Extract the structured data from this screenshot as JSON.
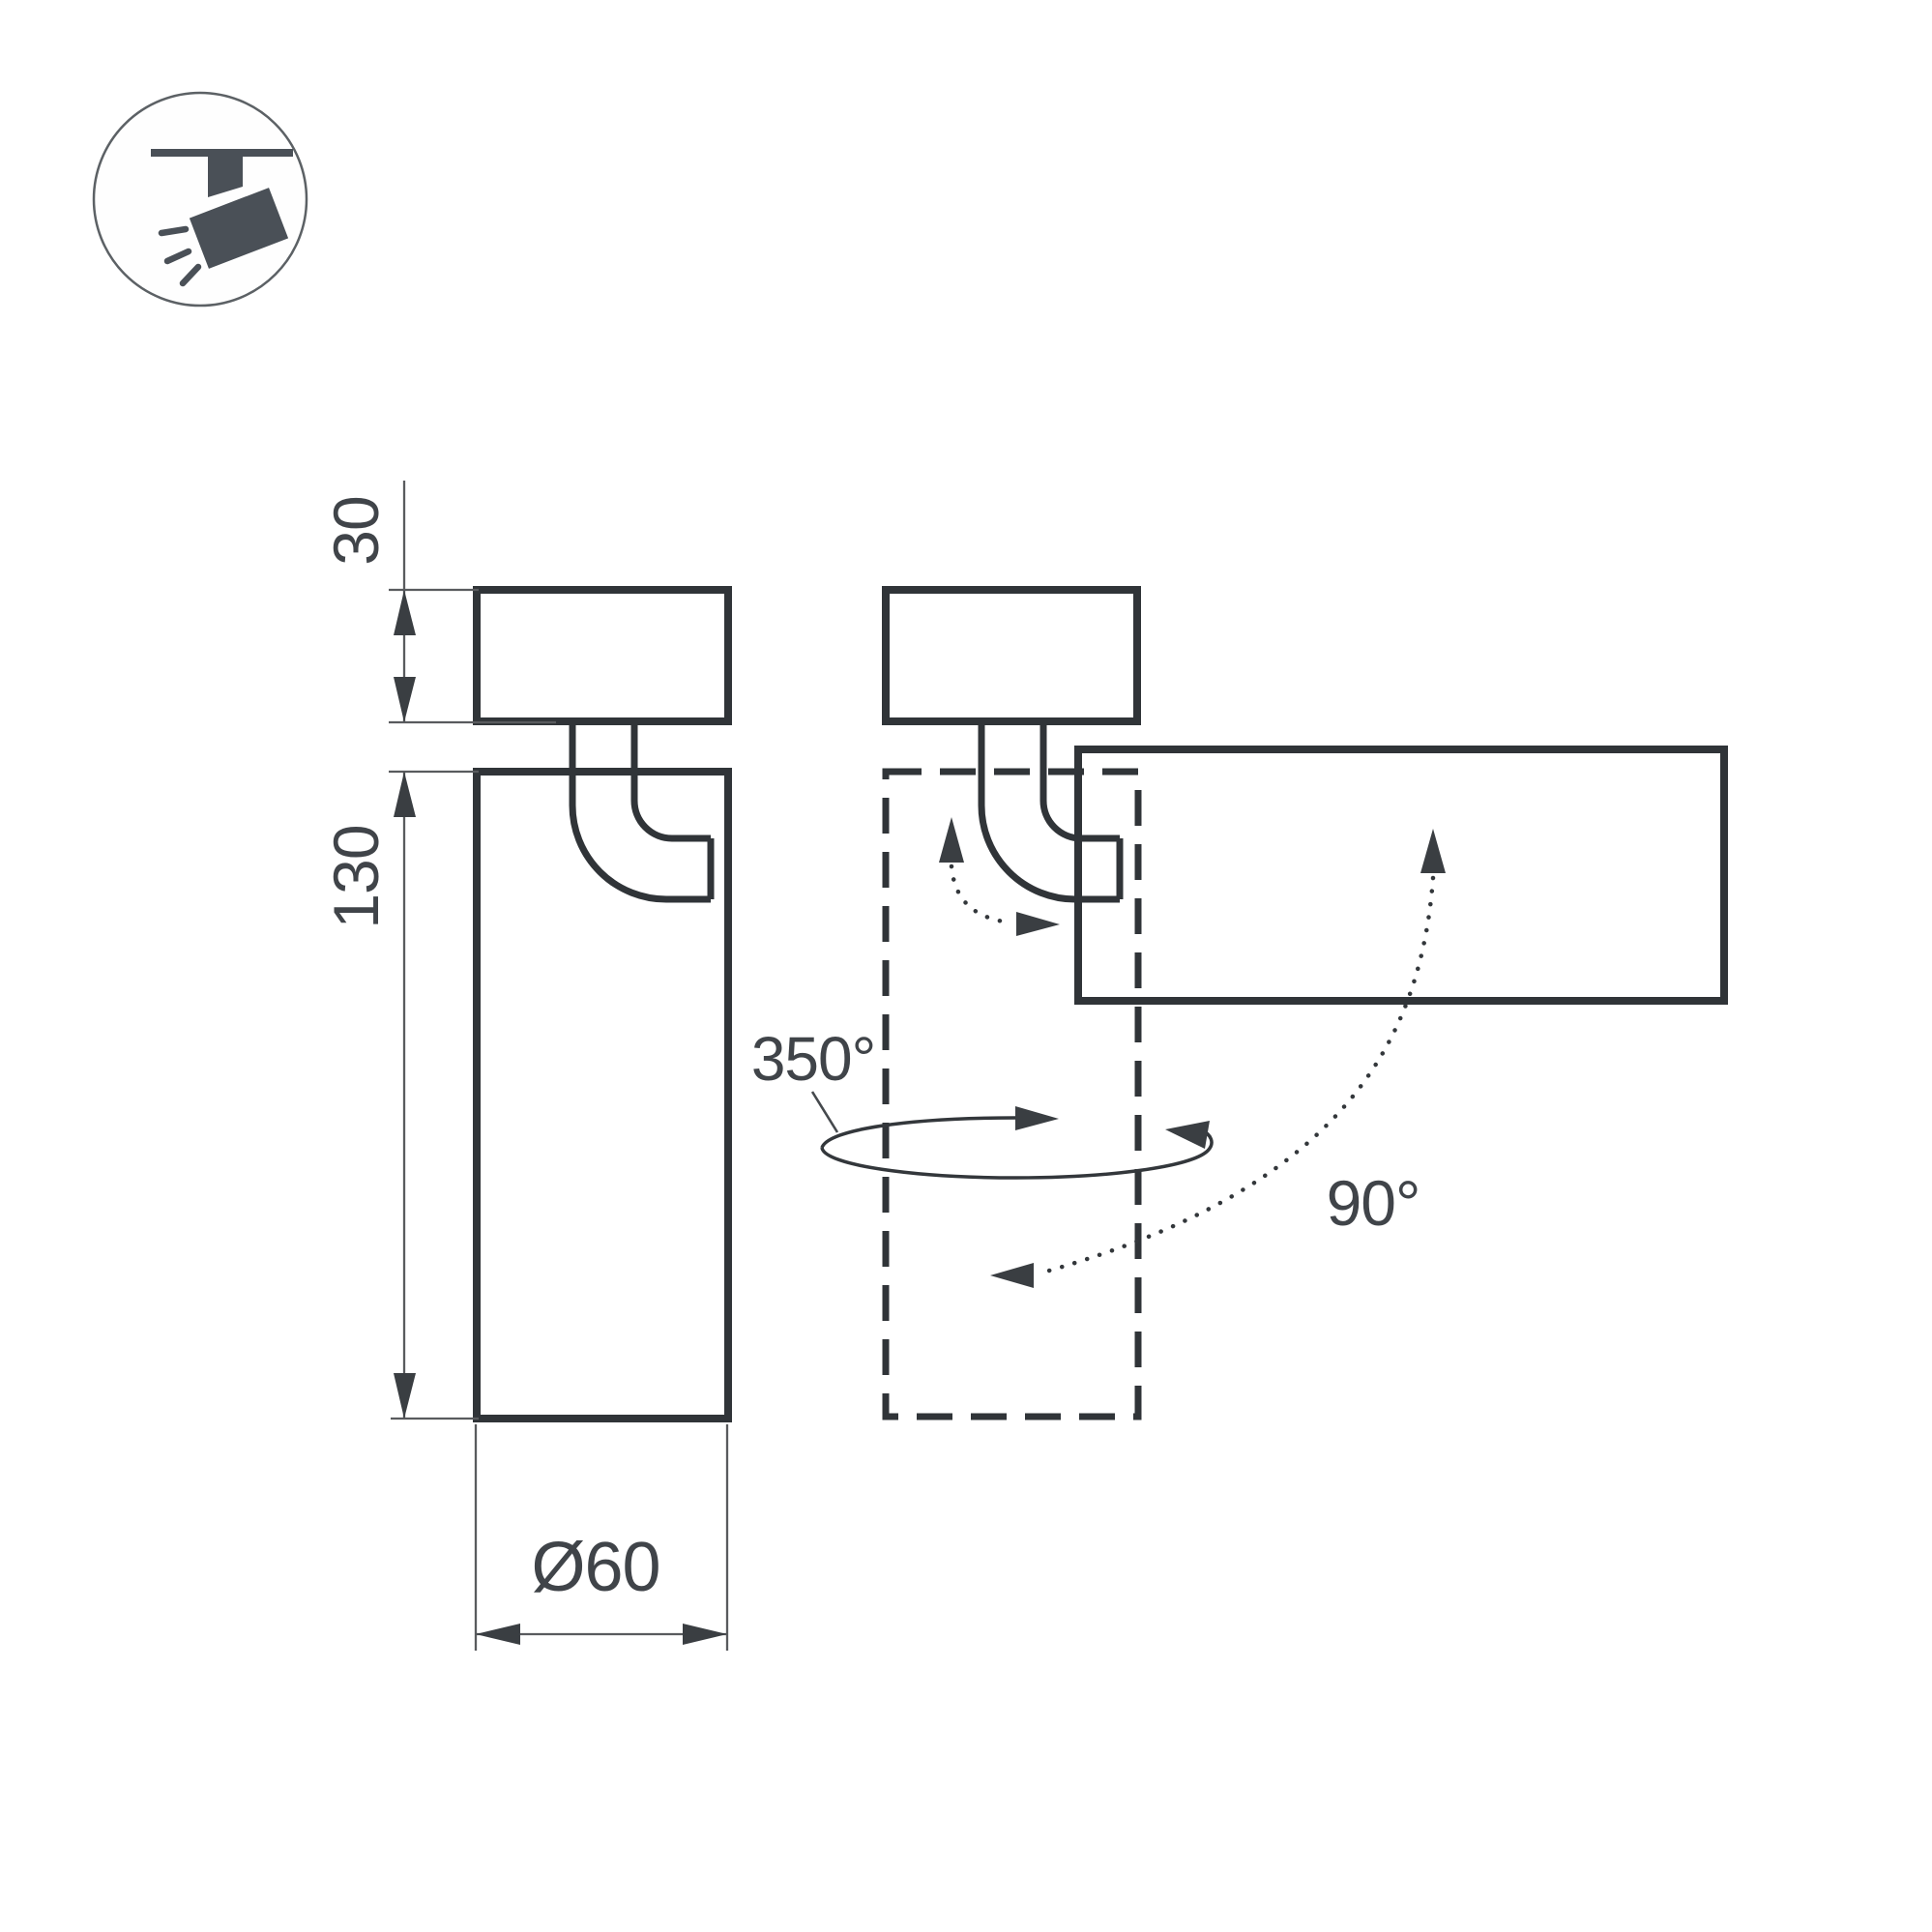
{
  "labels": {
    "mount_height": "30",
    "body_length": "130",
    "diameter": "Ø60",
    "pan_rotation": "350°",
    "tilt_rotation": "90°"
  },
  "icon": {
    "name": "ceiling-track-spotlight-icon"
  },
  "colors": {
    "background": "#ffffff",
    "outline": "#303438",
    "dimension_line": "#595b5e",
    "label_text": "#404449",
    "arrow_fill": "#3a3e42",
    "icon_fill": "#4a5057",
    "icon_circle_stroke": "#5c6165"
  }
}
